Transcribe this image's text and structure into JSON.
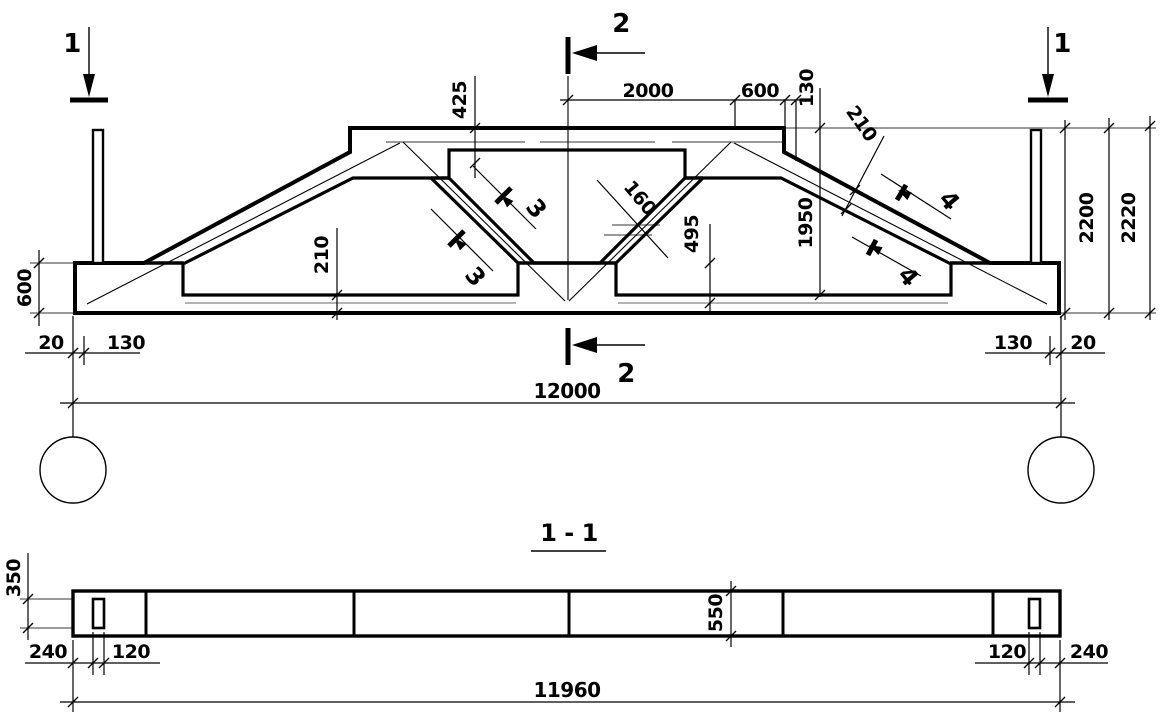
{
  "elevation": {
    "marker_1_left": "1",
    "marker_1_right": "1",
    "marker_2_top": "2",
    "marker_2_bottom": "2",
    "marker_3_upper": "3",
    "marker_3_lower": "3",
    "marker_4_upper": "4",
    "marker_4_lower": "4",
    "dim_top_center_to_slope": "2000",
    "dim_top_slope": "600",
    "dim_top_edge": "130",
    "dim_top_chord_depth": "425",
    "dim_web_width": "160",
    "dim_node_height": "495",
    "dim_bottom_chord_depth": "210",
    "dim_slope_chord_depth": "210",
    "dim_end_height": "1950",
    "dim_height_to_top": "2200",
    "dim_height_overall": "2220",
    "dim_support_depth": "600",
    "dim_gap_left": "20",
    "dim_bearing_left": "130",
    "dim_bearing_right": "130",
    "dim_gap_right": "20",
    "dim_span": "12000"
  },
  "section": {
    "title": "1 - 1",
    "dim_hole_width": "350",
    "dim_end_left": "240",
    "dim_hole_left": "120",
    "dim_beam_width": "550",
    "dim_hole_right": "120",
    "dim_end_right": "240",
    "dim_length": "11960"
  }
}
